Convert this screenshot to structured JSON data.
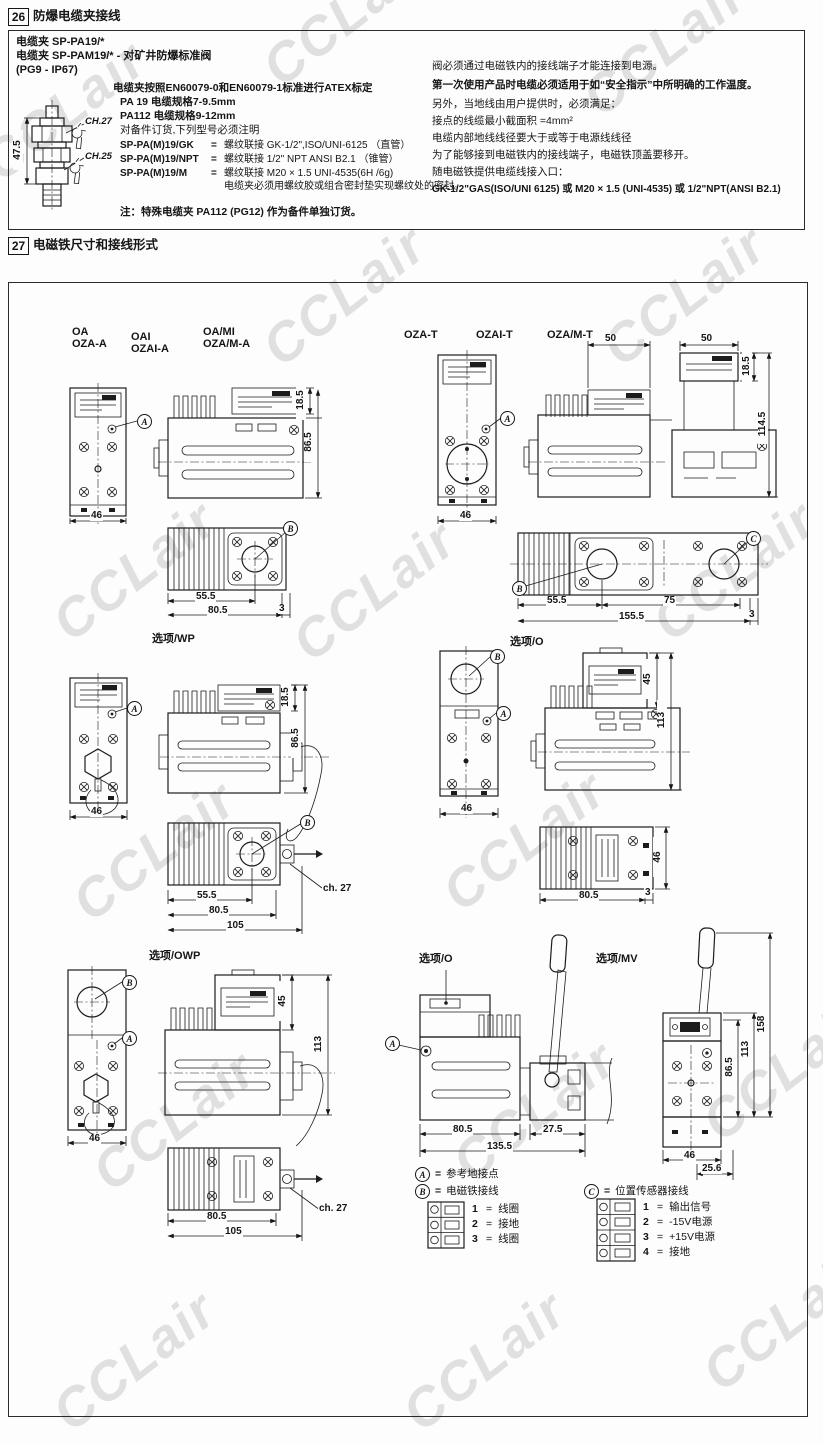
{
  "watermark": {
    "text": "CCLair"
  },
  "header26": {
    "num": "26",
    "title": "防爆电缆夹接线"
  },
  "box26": {
    "title_lines": [
      "电缆夹 SP-PA19/*",
      "电缆夹 SP-PAM19/* - 对矿井防爆标准阀",
      "(PG9 - IP67)"
    ],
    "clamp": {
      "dim_height": "47.5",
      "ch_top": "CH.27",
      "ch_bottom": "CH.25"
    },
    "spec": {
      "l1": "电缆夹按照EN60079-0和EN60079-1标准进行ATEX标定",
      "l2": "PA 19  电缆规格7-9.5mm",
      "l3": "PA112 电缆规格9-12mm",
      "l4": "对备件订货,下列型号必须注明"
    },
    "eq": "=",
    "models": [
      {
        "code": "SP-PA(M)19/GK",
        "desc": "螺纹联接 GK-1/2\",ISO/UNI-6125 （直管）"
      },
      {
        "code": "SP-PA(M)19/NPT",
        "desc": "螺纹联接 1/2\" NPT ANSI B2.1 （锥管）"
      },
      {
        "code": "SP-PA(M)19/M",
        "desc": "螺纹联接 M20 × 1.5 UNI-4535(6H /6g)"
      }
    ],
    "seal_note": "电缆夹必须用螺纹胶或组合密封垫实现螺纹处的密封。",
    "note": "注：特殊电缆夹 PA112 (PG12) 作为备件单独订货。",
    "right_lines": [
      "阀必须通过电磁铁内的接线端子才能连接到电源。",
      "第一次使用产品时电缆必须适用于如“安全指示”中所明确的工作温度。",
      "另外，当地线由用户提供时，必须满足：",
      "接点的线缆最小截面积 =4mm²",
      "电缆内部地线线径要大于或等于电源线线径",
      "为了能够接到电磁铁内的接线端子，电磁铁顶盖要移开。",
      "随电磁铁提供电缆线接入口：",
      "GK-1/2\"GAS(ISO/UNI 6125) 或 M20 × 1.5 (UNI-4535) 或 1/2\"NPT(ANSI B2.1)"
    ]
  },
  "header27": {
    "num": "27",
    "title": "电磁铁尺寸和接线形式"
  },
  "box27": {
    "groups": {
      "g1a": "OA",
      "g1b": "OZA-A",
      "g2a": "OAI",
      "g2b": "OZAI-A",
      "g3a": "OA/MI",
      "g3b": "OZA/M-A",
      "g4": "OZA-T",
      "g5": "OZAI-T",
      "g6": "OZA/M-T",
      "opt_wp": "选项/WP",
      "opt_o1": "选项/O",
      "opt_owp": "选项/OWP",
      "opt_o2": "选项/O",
      "opt_mv": "选项/MV"
    },
    "callout": {
      "a": "A",
      "b": "B",
      "c": "C"
    },
    "dims": {
      "r1l": {
        "w46": "46",
        "h185": "18.5",
        "h865": "86.5",
        "b555": "55.5",
        "b805": "80.5",
        "b3": "3"
      },
      "r1r": {
        "t50a": "50",
        "t50b": "50",
        "h185": "18.5",
        "h1145": "114.5",
        "w46": "46",
        "b555": "55.5",
        "b75": "75",
        "b1555": "155.5",
        "b3": "3"
      },
      "r2l": {
        "w46": "46",
        "h185": "18.5",
        "h865": "86.5",
        "b555": "55.5",
        "b805": "80.5",
        "b105": "105",
        "ch27": "ch. 27"
      },
      "r2r": {
        "w46": "46",
        "h45": "45",
        "h113": "113",
        "b805": "80.5",
        "b3": "3",
        "s46": "46"
      },
      "r3l": {
        "w46": "46",
        "h45": "45",
        "h113": "113",
        "b805": "80.5",
        "b105": "105",
        "ch27": "ch. 27"
      },
      "r3m": {
        "b805": "80.5",
        "b275": "27.5",
        "b1355": "135.5"
      },
      "r3r": {
        "h865": "86.5",
        "h113": "113",
        "h158": "158",
        "w46": "46",
        "w256": "25.6"
      }
    },
    "legend": {
      "eq": "=",
      "a": {
        "letter": "A",
        "text": "参考地接点"
      },
      "b": {
        "letter": "B",
        "text": "电磁铁接线",
        "pins": [
          {
            "n": "1",
            "v": "线圈"
          },
          {
            "n": "2",
            "v": "接地"
          },
          {
            "n": "3",
            "v": "线圈"
          }
        ]
      },
      "c": {
        "letter": "C",
        "text": "位置传感器接线",
        "pins": [
          {
            "n": "1",
            "v": "输出信号"
          },
          {
            "n": "2",
            "v": "-15V电源"
          },
          {
            "n": "3",
            "v": "+15V电源"
          },
          {
            "n": "4",
            "v": "接地"
          }
        ]
      }
    }
  }
}
